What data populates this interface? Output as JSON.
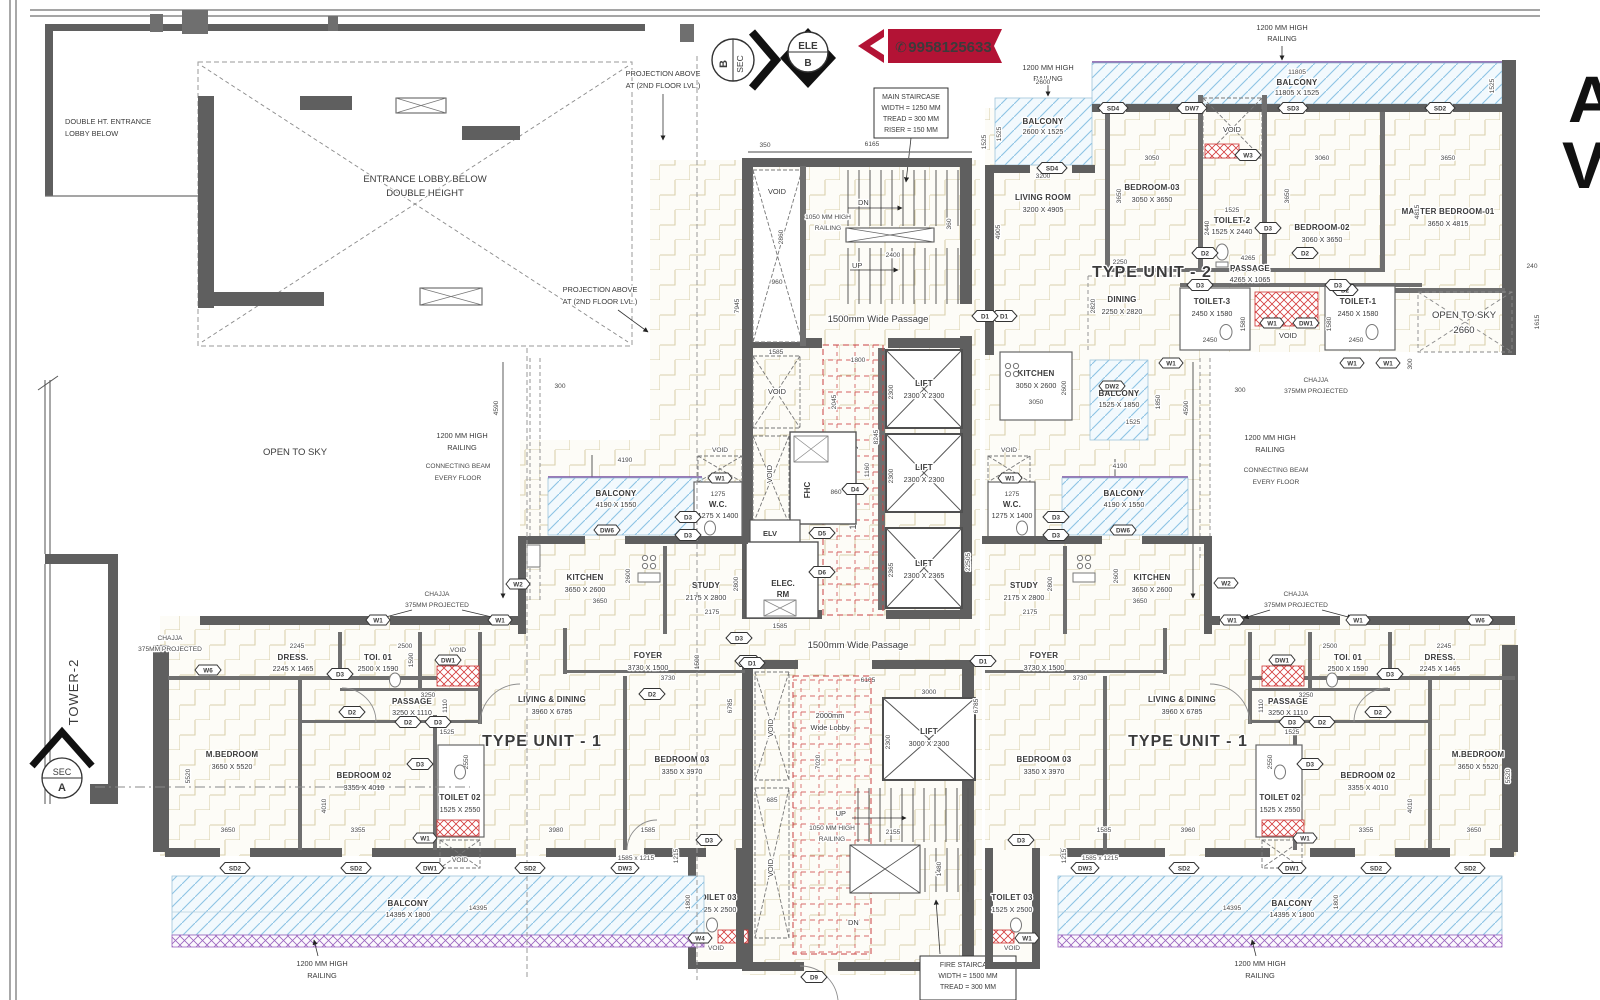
{
  "colors": {
    "accent_red": "#c9231c",
    "ribbon": "#b31335",
    "wall": "#5f5f5f",
    "balcony_blue": "#8cc3e4",
    "purple": "#9a63be",
    "floor_line": "#d9d1ac"
  },
  "phone": {
    "icon": "✆",
    "number": "9958125633"
  },
  "annotations": {
    "projection_l1": "PROJECTION ABOVE",
    "projection_l2": "AT (2ND FLOOR LVL.)",
    "double_ht_l1": "DOUBLE HT. ENTRANCE",
    "double_ht_l2": "LOBBY BELOW",
    "entrance_l1": "ENTRANCE LOBBY BELOW",
    "entrance_l2": "DOUBLE HEIGHT",
    "open_to_sky": "OPEN TO SKY",
    "open_to_sky_dim": "2660",
    "tower2": "TOWER-2",
    "sec": "SEC",
    "a": "A",
    "b": "B",
    "ele": "ELE",
    "railing1200_l1": "1200 MM HIGH",
    "railing1200_l2": "RAILING",
    "railing1050_l1": "1050 MM HIGH",
    "railing1050_l2": "RAILING",
    "beam_l1": "CONNECTING BEAM",
    "beam_l2": "EVERY FLOOR",
    "chajja_l1": "CHAJJA",
    "chajja_l2": "375MM PROJECTED",
    "up": "UP",
    "dn": "DN",
    "void": "VOID",
    "letter_a": "A",
    "letter_v": "V"
  },
  "staircase_box": {
    "l1": "MAIN STAIRCASE",
    "l2": "WIDTH = 1250 MM",
    "l3": "TREAD = 300 MM",
    "l4": "RISER = 150 MM"
  },
  "fire_box": {
    "l1": "FIRE STAIRCASE",
    "l2": "WIDTH = 1500 MM",
    "l3": "TREAD = 300 MM"
  },
  "core": {
    "passage_top": "1500mm Wide Passage",
    "passage_bottom": "1500mm Wide Passage",
    "lobby1800": "1800mm Wide Lobby",
    "lobby2000_l1": "2000mm",
    "lobby2000_l2": "Wide Lobby",
    "lift": "LIFT",
    "lift_2300": "2300 X 2300",
    "lift_2365": "2300 X 2365",
    "lift_3000": "3000 X 2300",
    "fhc": "FHC",
    "elv": "ELV",
    "elec_l1": "ELEC.",
    "elec_l2": "RM"
  },
  "unit2": {
    "label": "TYPE UNIT - 2",
    "living": {
      "n": "LIVING ROOM",
      "s": "3200 X 4905"
    },
    "bed3": {
      "n": "BEDROOM-03",
      "s": "3050 X 3650"
    },
    "toilet2": {
      "n": "TOILET-2",
      "s": "1525 X 2440"
    },
    "bed2": {
      "n": "BEDROOM-02",
      "s": "3060 X 3650"
    },
    "master": {
      "n": "MASTER BEDROOM-01",
      "s": "3650 X 4815"
    },
    "dining": {
      "n": "DINING",
      "s": "2250 X 2820"
    },
    "kitchen": {
      "n": "KITCHEN",
      "s": "3050 X 2600"
    },
    "toilet3": {
      "n": "TOILET-3",
      "s": "2450 X 1580"
    },
    "toilet1": {
      "n": "TOILET-1",
      "s": "2450 X 1580"
    },
    "passage": {
      "n": "PASSAGE",
      "s": "4265 X 1065"
    },
    "balcony_top": {
      "n": "BALCONY",
      "s": "11805 X 1525"
    },
    "balcony_small": {
      "n": "BALCONY",
      "s": "2600 X 1525"
    },
    "balcony_mid": {
      "n": "BALCONY",
      "s": "1525 X 1850"
    }
  },
  "unit1": {
    "label": "TYPE UNIT - 1",
    "mbed": {
      "n": "M.BEDROOM",
      "s": "3650 X 5520"
    },
    "bed2": {
      "n": "BEDROOM 02",
      "s": "3355 X 4010"
    },
    "bed3": {
      "n": "BEDROOM 03",
      "s": "3350 X 3970"
    },
    "living": {
      "n": "LIVING & DINING",
      "s": "3960 X 6785"
    },
    "kitchen": {
      "n": "KITCHEN",
      "s": "3650 X 2600"
    },
    "study": {
      "n": "STUDY",
      "s": "2175 X 2800"
    },
    "foyer": {
      "n": "FOYER",
      "s": "3730 X 1500"
    },
    "dress": {
      "n": "DRESS.",
      "s": "2245 X 1465"
    },
    "toi01": {
      "n": "TOI. 01",
      "s": "2500 X 1590"
    },
    "toilet02": {
      "n": "TOILET 02",
      "s": "1525 X 2550"
    },
    "toilet03": {
      "n": "TOILET 03",
      "s": "1525 X 2500"
    },
    "wc": {
      "n": "W.C.",
      "s": "1275 X 1400"
    },
    "wc_top": "1275",
    "passage": {
      "n": "PASSAGE",
      "s": "3250 X 1110"
    },
    "balcony": {
      "n": "BALCONY",
      "s": "14395 X 1800"
    },
    "balcony_mid": {
      "n": "BALCONY",
      "s": "4190 X 1550"
    }
  },
  "markers": {
    "d1": "D1",
    "d2": "D2",
    "d3": "D3",
    "d4": "D4",
    "d5": "D5",
    "d6": "D6",
    "d9": "D9",
    "w1": "W1",
    "w2": "W2",
    "w3": "W3",
    "w4": "W4",
    "w6": "W6",
    "dw1": "DW1",
    "dw2": "DW2",
    "dw3": "DW3",
    "dw6": "DW6",
    "dw7": "DW7",
    "sd2": "SD2",
    "sd3": "SD3",
    "sd4": "SD4"
  },
  "dims": {
    "n350": "350",
    "n6165": "6165",
    "n1525": "1525",
    "n7945": "7945",
    "n2860": "2860",
    "n960": "960",
    "n2400": "2400",
    "n360": "360",
    "n11805": "11805",
    "n2600": "2600",
    "n3200": "3200",
    "n4905": "4905",
    "n3050": "3050",
    "n3650": "3650",
    "n2440": "2440",
    "n3060": "3060",
    "n4815": "4815",
    "n2250": "2250",
    "n2820": "2820",
    "n4265": "4265",
    "n2450": "2450",
    "n1580": "1580",
    "n240": "240",
    "n1615": "1615",
    "n300": "300",
    "n4590": "4590",
    "n4190": "4190",
    "n2175": "2175",
    "n2800": "2800",
    "n1585": "1585",
    "n1800": "1800",
    "n2045": "2045",
    "n2300": "2300",
    "n8245": "8245",
    "n2365": "2365",
    "n22505": "22505",
    "n525": "525",
    "n1060": "1060",
    "n1160": "1160",
    "n860": "860",
    "n3000": "3000",
    "n7020": "7020",
    "n685": "685",
    "n2155": "2155",
    "n1480": "1480",
    "n6785": "6785",
    "n3730": "3730",
    "n1500": "1500",
    "n3980": "3980",
    "n3960": "3960",
    "n1215": "1215",
    "n1585x1215": "1585 x 1215",
    "n2245": "2245",
    "n1465": "1465",
    "n2500": "2500",
    "n1590": "1590",
    "n3250": "3250",
    "n1110": "1110",
    "n5520": "5520",
    "n4010": "4010",
    "n3355": "3355",
    "n2550": "2550",
    "n14395": "14395",
    "n1850": "1850",
    "n1065": "1065"
  }
}
